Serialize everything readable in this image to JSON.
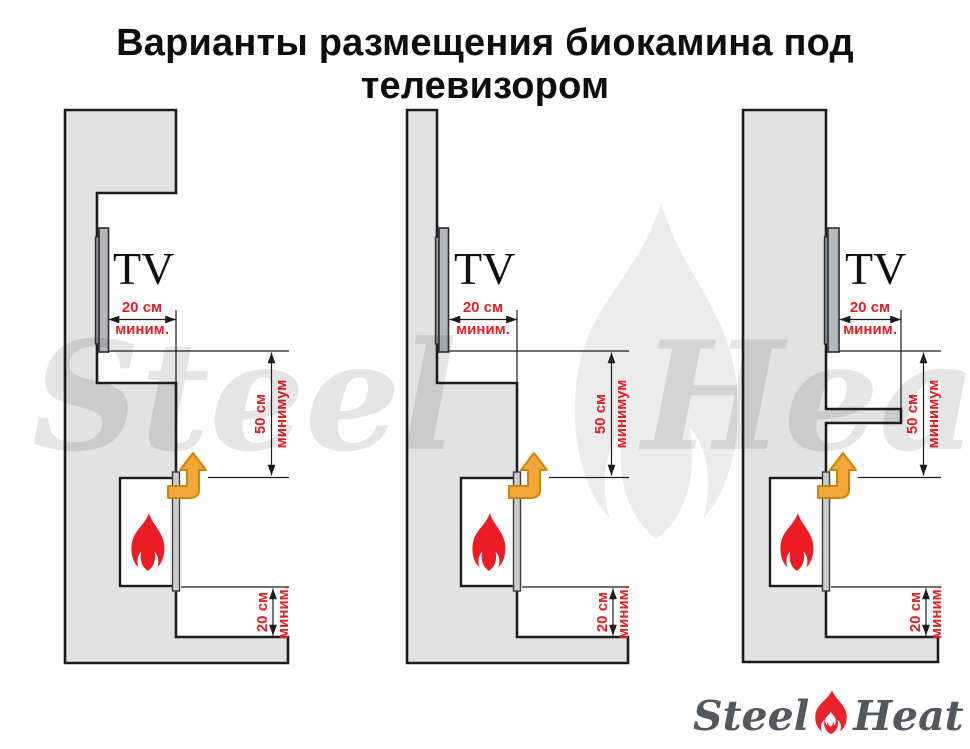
{
  "title": "Варианты размещения биокамина под телевизором",
  "diagrams": [
    {
      "tv_label": "TV",
      "top_clearance": {
        "value": "20 см",
        "qualifier": "миним."
      },
      "vertical_clearance": {
        "value": "50 см",
        "qualifier": "минимум"
      },
      "bottom_clearance": {
        "value": "20 см",
        "qualifier": "миним."
      }
    },
    {
      "tv_label": "TV",
      "top_clearance": {
        "value": "20 см",
        "qualifier": "миним."
      },
      "vertical_clearance": {
        "value": "50 см",
        "qualifier": "минимум"
      },
      "bottom_clearance": {
        "value": "20 см",
        "qualifier": "миним."
      }
    },
    {
      "tv_label": "TV",
      "top_clearance": {
        "value": "20 см",
        "qualifier": "миним."
      },
      "vertical_clearance": {
        "value": "50 см",
        "qualifier": "минимум"
      },
      "bottom_clearance": {
        "value": "20 см",
        "qualifier": "миним."
      }
    }
  ],
  "watermark": {
    "left": "Steel",
    "right": "Heat"
  },
  "logo": {
    "left": "Steel",
    "right": "Heat"
  },
  "colors": {
    "dimension_red": "#e31e24",
    "flame_red": "#ec1c24",
    "arrow_orange": "#f3a73b",
    "wall_gray": "#e2e2e2",
    "logo_text": "#54585e"
  }
}
